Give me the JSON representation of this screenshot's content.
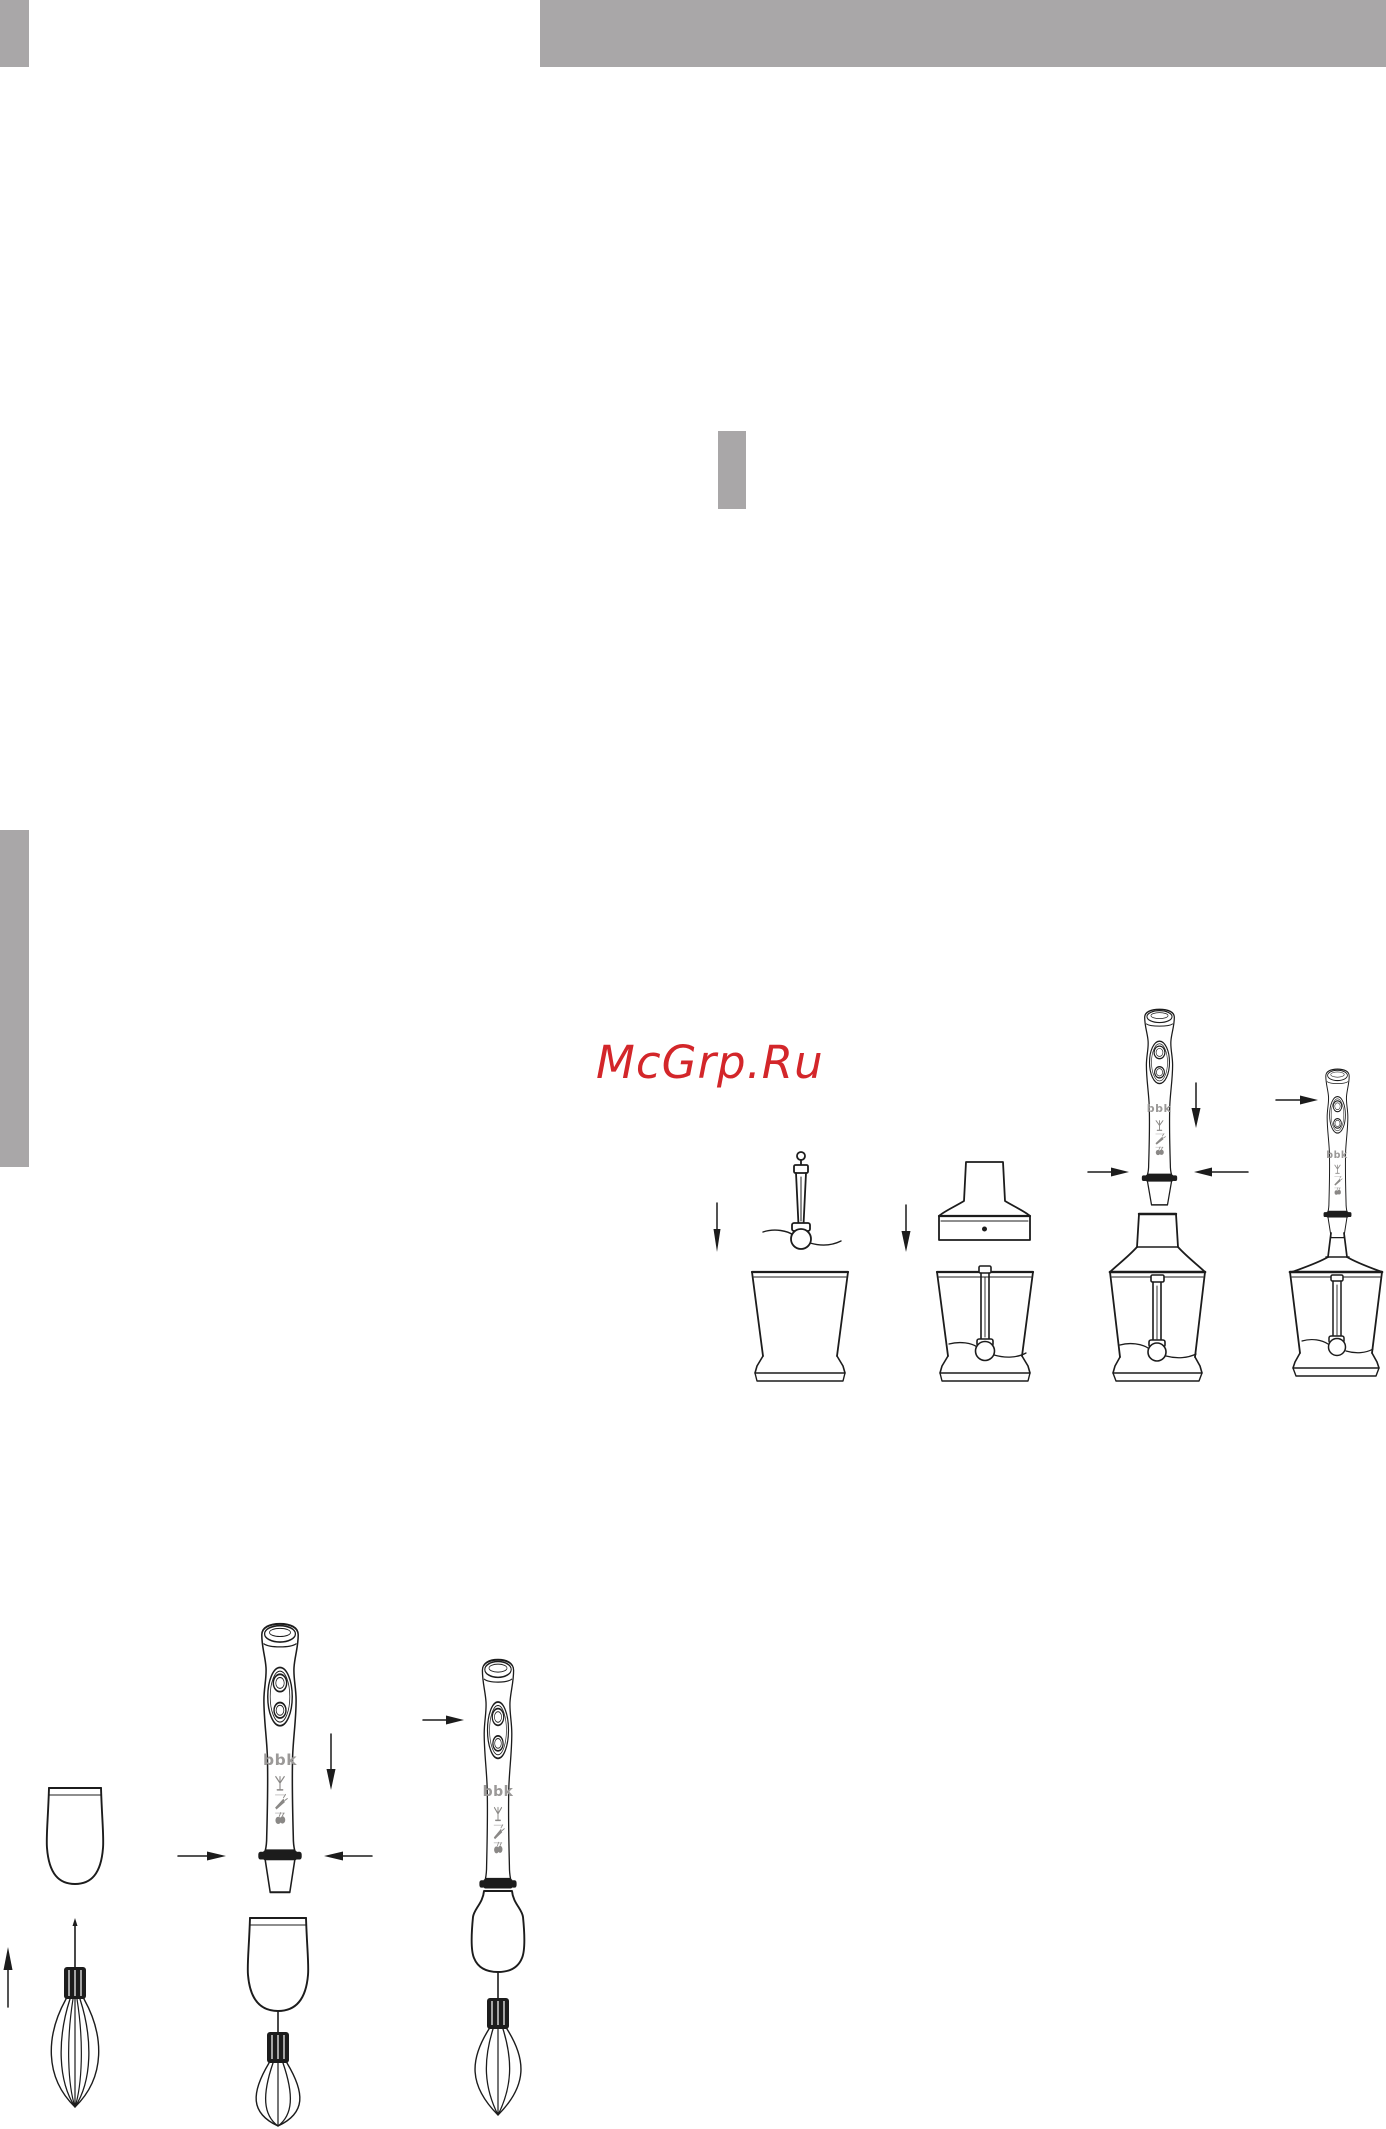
{
  "watermark": {
    "text": "McGrp.Ru",
    "color": "#d3262a"
  },
  "brand": {
    "logo_text": "bbk",
    "logo_color": "#9b9998"
  },
  "decor": {
    "gray_bar_color": "#a9a7a8"
  },
  "illustration": {
    "line_color": "#1c1c1c",
    "chopper_assembly_steps": [
      "insert-chopping-blade-into-bowl",
      "place-gearbox-lid-onto-bowl",
      "attach-motor-unit-to-lid",
      "assembled-chopper"
    ],
    "whisk_assembly_steps": [
      "whisk-and-coupling-parts",
      "attach-motor-unit-to-whisk-gearbox",
      "assembled-whisk"
    ],
    "motor_mode_icons": [
      "whisk-mode-icon",
      "carrot-mode-icon",
      "berries-mode-icon"
    ]
  }
}
